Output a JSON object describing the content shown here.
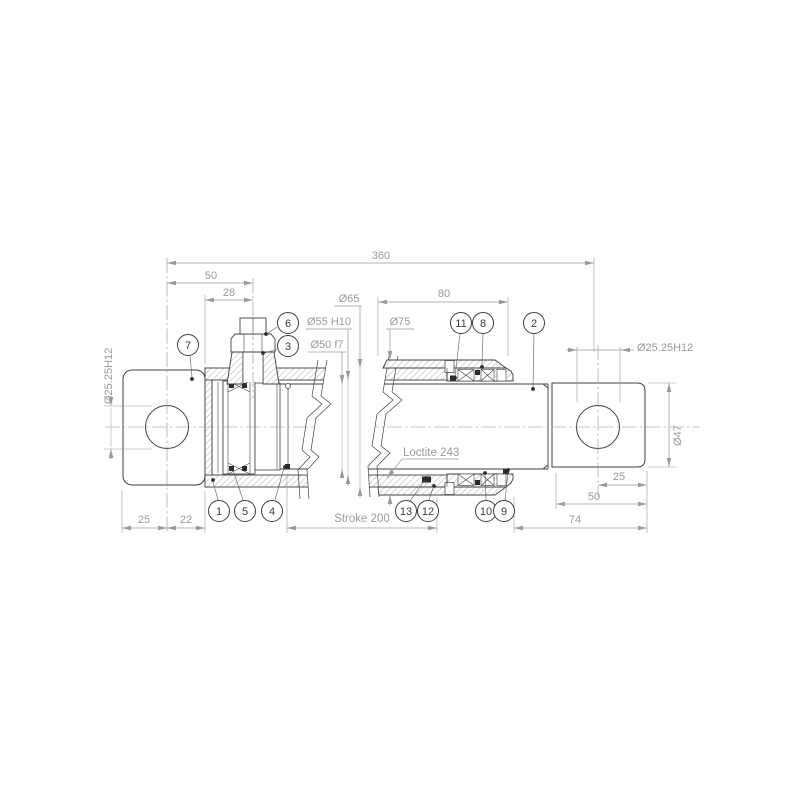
{
  "title": "Hydraulic cylinder cross-section technical drawing",
  "colors": {
    "background": "#ffffff",
    "outline": "#3f3f3f",
    "dim_lines": "#9a9a9a",
    "balloon": "#3c3c3c"
  },
  "dims": {
    "overall": "360",
    "pin_to_port": "50",
    "cap_to_port": "28",
    "head_length": "80",
    "tube_od": "Ø65",
    "bore": "Ø55 H10",
    "rod_dia": "Ø50 f7",
    "head_od": "Ø75",
    "pin_bore_left": "Ø25.25H12",
    "pin_bore_right": "Ø25.25H12",
    "rod_end_od": "Ø47",
    "left_25": "25",
    "left_22": "22",
    "stroke": "Stroke 200",
    "right_74": "74",
    "right_50": "50",
    "right_25": "25"
  },
  "note": {
    "thread_lock": "Loctite 243"
  },
  "balloons": [
    {
      "label": "7"
    },
    {
      "label": "6"
    },
    {
      "label": "3"
    },
    {
      "label": "11"
    },
    {
      "label": "8"
    },
    {
      "label": "2"
    },
    {
      "label": "1"
    },
    {
      "label": "5"
    },
    {
      "label": "4"
    },
    {
      "label": "13"
    },
    {
      "label": "12"
    },
    {
      "label": "10"
    },
    {
      "label": "9"
    }
  ]
}
